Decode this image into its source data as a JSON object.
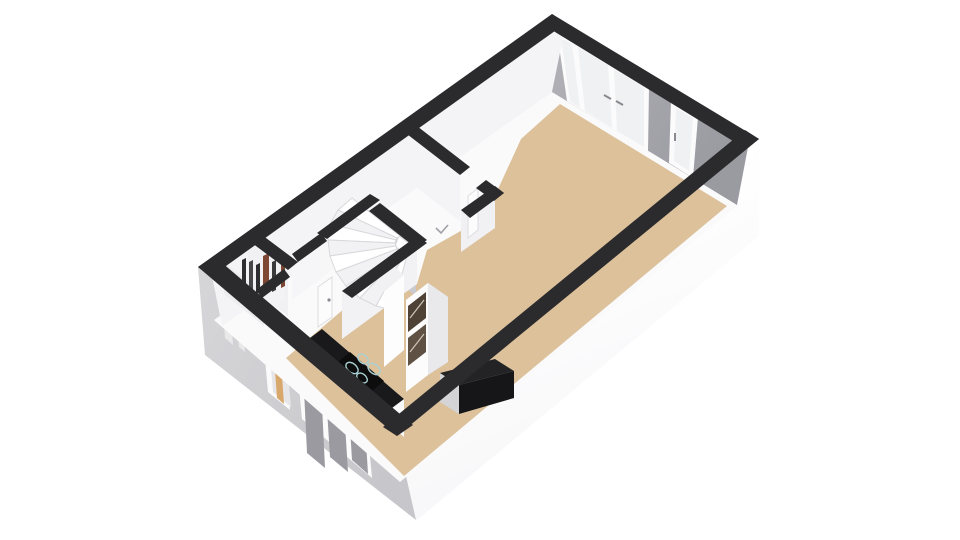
{
  "scene": {
    "type": "3d-floorplan-render",
    "view": "isometric-top-down",
    "background": "#ffffff",
    "elements": [
      "living-room-floor",
      "entrance-hall-floor",
      "winder-staircase",
      "storage-closet-slats",
      "french-doors",
      "glazed-back-door",
      "kitchen-window",
      "entrance-door",
      "kitchen-counter",
      "kitchen-cooktop",
      "kitchen-tall-unit",
      "bar-counter",
      "interior-door",
      "door-swing-mark"
    ]
  },
  "colors": {
    "background": "#ffffff",
    "wall_top": "#2b2b2d",
    "ext_face_white": "#fdfdfe",
    "ext_face_gray": "#cfcfd2",
    "ext_seam": "#e9e9ea",
    "int_wall_white": "#f4f4f6",
    "int_wall_light": "#f7f7f8",
    "int_wall_gray": "#a9a9af",
    "stairwell_gray": "#c9c9ce",
    "floor_tan": "#dcc19b",
    "floor_white": "#fafafb",
    "glass_light": "#f0f1f2",
    "glass_dark": "#9a9aa0",
    "glass_upper": "#b8b8bd",
    "frame_white": "#fbfbfc",
    "counter_black": "#19191b",
    "cooktop_black": "#0d0d0e",
    "ring_teal": "#a8cfd2",
    "appliance_glass": "#4e4237",
    "appliance_glass2": "#5f5143",
    "cabinet_white": "#fafafb",
    "unit_side": "#e9e9ec",
    "unit_top": "#f1f1f3",
    "bar_top": "#232325",
    "bar_front": "#161618",
    "bar_end": "#d4d4d7",
    "door_tan": "#d8a76c",
    "door_recess": "#e6e6e8",
    "slat_dark": "#2e2e30",
    "slat_mid": "#47474a",
    "slat_red": "#7d4733",
    "tread_white": "#ffffff",
    "tread_alt": "#f2f2f4",
    "tread_edge": "#d8d8db",
    "door_leaf": "#fcfcfd",
    "handle_gray": "#8a8a90",
    "mark_gray": "#a0a0a6"
  }
}
